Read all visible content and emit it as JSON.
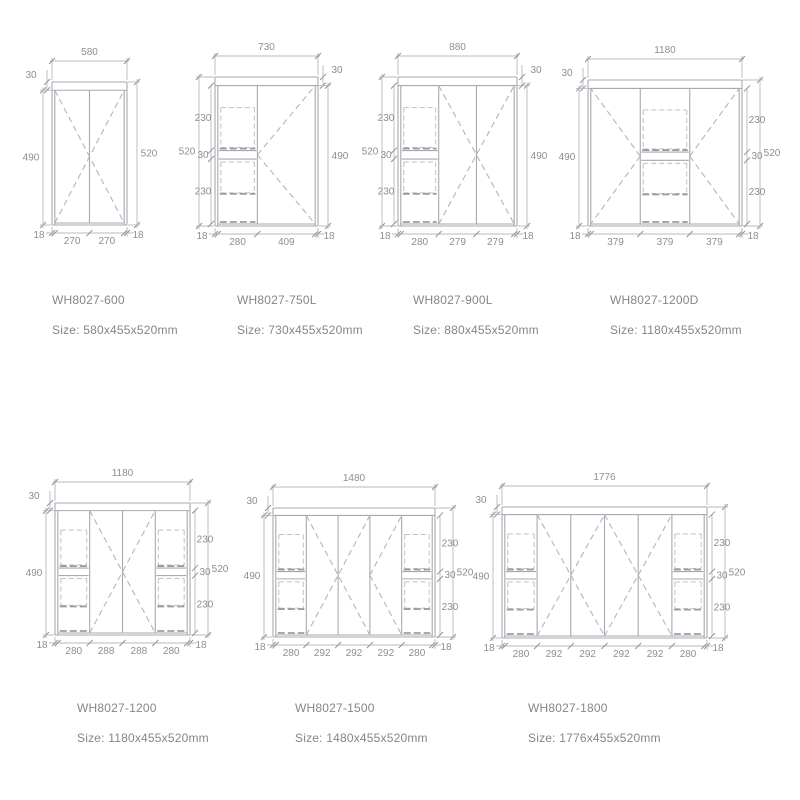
{
  "page": {
    "background": "#ffffff"
  },
  "colors": {
    "line": "#a6a9af",
    "dim_line": "#b5b8bd",
    "dash": "#b2b5ba",
    "label_text": "#84868b",
    "dim_text": "#8c8e93"
  },
  "cabinets": [
    {
      "model": "WH8027-600",
      "size": "Size: 580x455x520mm",
      "box": {
        "x": 52,
        "y": 82,
        "w": 75,
        "h": 143
      },
      "cols": [
        270,
        270
      ],
      "decor": [
        {
          "type": "x",
          "cols": [
            0,
            1
          ]
        }
      ],
      "dims": {
        "top": "580",
        "top30": {
          "side": "left",
          "label": "30"
        },
        "left": {
          "label": "490",
          "span": "inner"
        },
        "right": {
          "label": "520",
          "span": "full"
        },
        "inner": null,
        "bottom": [
          "18",
          "270",
          "270",
          "18"
        ]
      }
    },
    {
      "model": "WH8027-750L",
      "size": "Size: 730x455x520mm",
      "box": {
        "x": 215,
        "y": 77,
        "w": 103,
        "h": 149
      },
      "cols": [
        280,
        409
      ],
      "decor": [
        {
          "type": "drawers",
          "col": 0
        },
        {
          "type": "door",
          "col": 1,
          "vertex": "left"
        }
      ],
      "dims": {
        "top": "730",
        "top30": {
          "side": "right",
          "label": "30"
        },
        "left": {
          "label": "520",
          "span": "full"
        },
        "right": {
          "label": "490",
          "span": "inner"
        },
        "inner": {
          "side": "left",
          "labels": [
            "230",
            "30",
            "230"
          ]
        },
        "bottom": [
          "18",
          "280",
          "409",
          "18"
        ]
      }
    },
    {
      "model": "WH8027-900L",
      "size": "Size: 880x455x520mm",
      "box": {
        "x": 398,
        "y": 77,
        "w": 119,
        "h": 149
      },
      "cols": [
        280,
        279,
        279
      ],
      "decor": [
        {
          "type": "drawers",
          "col": 0
        },
        {
          "type": "x",
          "cols": [
            1,
            2
          ]
        }
      ],
      "dims": {
        "top": "880",
        "top30": {
          "side": "right",
          "label": "30"
        },
        "left": {
          "label": "520",
          "span": "full"
        },
        "right": {
          "label": "490",
          "span": "inner"
        },
        "inner": {
          "side": "left",
          "labels": [
            "230",
            "30",
            "230"
          ]
        },
        "bottom": [
          "18",
          "280",
          "279",
          "279",
          "18"
        ]
      }
    },
    {
      "model": "WH8027-1200D",
      "size": "Size: 1180x455x520mm",
      "box": {
        "x": 588,
        "y": 80,
        "w": 154,
        "h": 146
      },
      "cols": [
        379,
        379,
        379
      ],
      "decor": [
        {
          "type": "door",
          "col": 0,
          "vertex": "right"
        },
        {
          "type": "drawers",
          "col": 1
        },
        {
          "type": "door",
          "col": 2,
          "vertex": "left"
        }
      ],
      "dims": {
        "top": "1180",
        "top30": {
          "side": "left",
          "label": "30"
        },
        "left": {
          "label": "490",
          "span": "inner"
        },
        "right": {
          "label": "520",
          "span": "full"
        },
        "inner": {
          "side": "right",
          "labels": [
            "230",
            "30",
            "230"
          ]
        },
        "bottom": [
          "18",
          "379",
          "379",
          "379",
          "18"
        ]
      }
    },
    {
      "model": "WH8027-1200",
      "size": "Size: 1180x455x520mm",
      "box": {
        "x": 55,
        "y": 503,
        "w": 135,
        "h": 132
      },
      "cols": [
        280,
        288,
        288,
        280
      ],
      "decor": [
        {
          "type": "drawers",
          "col": 0
        },
        {
          "type": "x",
          "cols": [
            1,
            2
          ]
        },
        {
          "type": "drawers",
          "col": 3
        }
      ],
      "dims": {
        "top": "1180",
        "top30": {
          "side": "left",
          "label": "30"
        },
        "left": {
          "label": "490",
          "span": "inner"
        },
        "right": {
          "label": "520",
          "span": "full"
        },
        "inner": {
          "side": "right",
          "labels": [
            "230",
            "30",
            "230"
          ]
        },
        "bottom": [
          "18",
          "280",
          "288",
          "288",
          "280",
          "18"
        ]
      }
    },
    {
      "model": "WH8027-1500",
      "size": "Size: 1480x455x520mm",
      "box": {
        "x": 273,
        "y": 508,
        "w": 162,
        "h": 129
      },
      "cols": [
        280,
        292,
        292,
        292,
        280
      ],
      "decor": [
        {
          "type": "drawers",
          "col": 0
        },
        {
          "type": "x",
          "cols": [
            1,
            2
          ]
        },
        {
          "type": "door",
          "col": 3,
          "vertex": "left"
        },
        {
          "type": "drawers",
          "col": 4
        }
      ],
      "dims": {
        "top": "1480",
        "top30": {
          "side": "left",
          "label": "30"
        },
        "left": {
          "label": "490",
          "span": "inner"
        },
        "right": {
          "label": "520",
          "span": "full"
        },
        "inner": {
          "side": "right",
          "labels": [
            "230",
            "30",
            "230"
          ]
        },
        "bottom": [
          "18",
          "280",
          "292",
          "292",
          "292",
          "280",
          "18"
        ]
      }
    },
    {
      "model": "WH8027-1800",
      "size": "Size: 1776x455x520mm",
      "box": {
        "x": 502,
        "y": 507,
        "w": 205,
        "h": 131
      },
      "cols": [
        280,
        292,
        292,
        292,
        292,
        280
      ],
      "decor": [
        {
          "type": "drawers",
          "col": 0
        },
        {
          "type": "x",
          "cols": [
            1,
            2
          ]
        },
        {
          "type": "x",
          "cols": [
            3,
            4
          ]
        },
        {
          "type": "drawers",
          "col": 5
        }
      ],
      "dims": {
        "top": "1776",
        "top30": {
          "side": "left",
          "label": "30"
        },
        "left": {
          "label": "490",
          "span": "inner"
        },
        "right": {
          "label": "520",
          "span": "full"
        },
        "inner": {
          "side": "right",
          "labels": [
            "230",
            "30",
            "230"
          ]
        },
        "bottom": [
          "18",
          "280",
          "292",
          "292",
          "292",
          "292",
          "280",
          "18"
        ]
      }
    }
  ]
}
